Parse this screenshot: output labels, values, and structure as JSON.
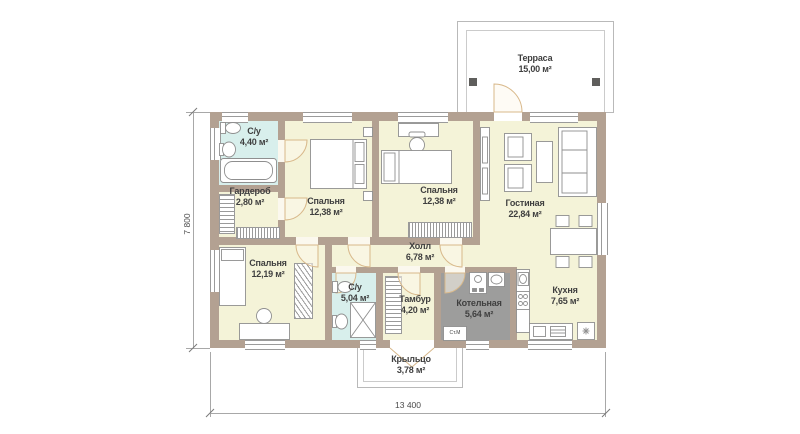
{
  "plan": {
    "rooms": [
      {
        "id": "terrace",
        "name": "Терраса",
        "area": "15,00 м²"
      },
      {
        "id": "bathroom-1",
        "name": "С/у",
        "area": "4,40 м²"
      },
      {
        "id": "wardrobe",
        "name": "Гардероб",
        "area": "2,80 м²"
      },
      {
        "id": "bedroom-1",
        "name": "Спальня",
        "area": "12,38 м²"
      },
      {
        "id": "bedroom-2",
        "name": "Спальня",
        "area": "12,38 м²"
      },
      {
        "id": "living-room",
        "name": "Гостиная",
        "area": "22,84 м²"
      },
      {
        "id": "hall",
        "name": "Холл",
        "area": "6,78 м²"
      },
      {
        "id": "bedroom-3",
        "name": "Спальня",
        "area": "12,19 м²"
      },
      {
        "id": "bathroom-2",
        "name": "С/у",
        "area": "5,04 м²"
      },
      {
        "id": "vestibule",
        "name": "Тамбур",
        "area": "4,20 м²"
      },
      {
        "id": "boiler-room",
        "name": "Котельная",
        "area": "5,64 м²"
      },
      {
        "id": "kitchen",
        "name": "Кухня",
        "area": "7,65 м²"
      },
      {
        "id": "porch",
        "name": "Крыльцо",
        "area": "3,78 м²"
      }
    ],
    "dimensions": {
      "width": "13 400",
      "height": "7 800"
    },
    "labels": {
      "washing_machine": "Ст.М"
    },
    "colors": {
      "wall": "#b3a192",
      "room_fill": "#f4f3d8",
      "wet_room_fill": "#d8efec",
      "boiler_fill": "#9d9d9c",
      "door_swing": "#d8b88a",
      "terrace_post": "#5f5e5c"
    }
  }
}
